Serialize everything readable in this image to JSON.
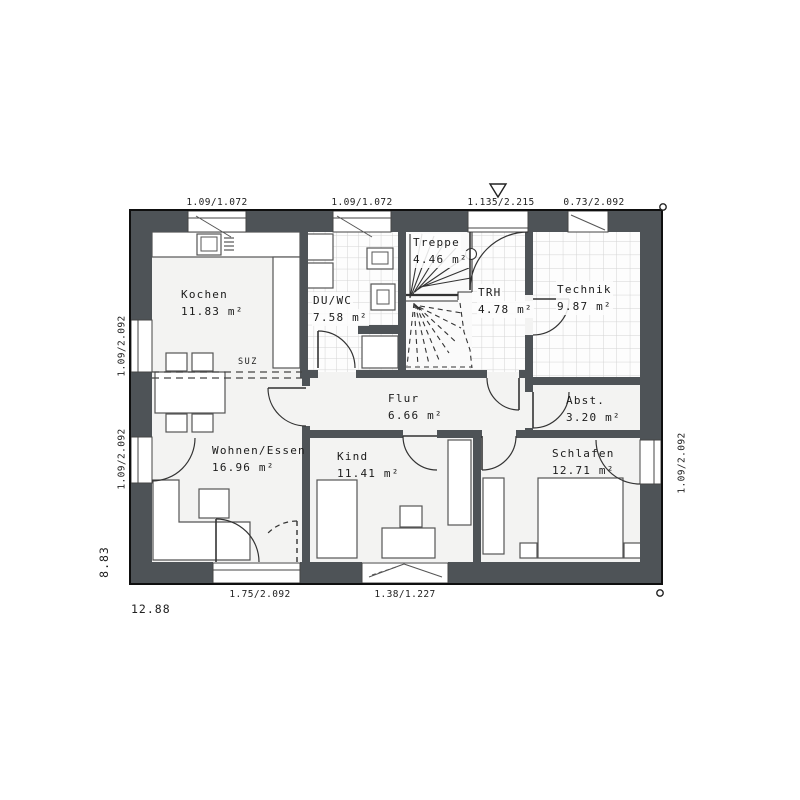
{
  "rooms": {
    "kochen": {
      "name": "Kochen",
      "area": "11.83 m²"
    },
    "duwc": {
      "name": "DU/WC",
      "area": "7.58 m²"
    },
    "treppe": {
      "name": "Treppe",
      "area": "4.46 m²"
    },
    "trh": {
      "name": "TRH",
      "area": "4.78 m²"
    },
    "technik": {
      "name": "Technik",
      "area": "9.87 m²"
    },
    "flur": {
      "name": "Flur",
      "area": "6.66 m²"
    },
    "abst": {
      "name": "Abst.",
      "area": "3.20 m²"
    },
    "wohnen": {
      "name": "Wohnen/Essen",
      "area": "16.96 m²"
    },
    "kind": {
      "name": "Kind",
      "area": "11.41 m²"
    },
    "schlafen": {
      "name": "Schlafen",
      "area": "12.71 m²"
    }
  },
  "dimensions": {
    "top": {
      "kochen_window": "1.09/1.072",
      "duwc_window": "1.09/1.072",
      "entrance_door": "1.135/2.215",
      "technik_window": "0.73/2.092"
    },
    "left": {
      "upper_window": "1.09/2.092",
      "lower_door": "1.09/2.092"
    },
    "right": {
      "balcony_door": "1.09/2.092"
    },
    "bottom": {
      "terrace_door": "1.75/2.092",
      "kind_window": "1.38/1.227"
    },
    "total_width": "12.88",
    "total_height": "8.83"
  },
  "annotations": {
    "suz": "SUZ"
  },
  "colors": {
    "wall": "#4e5357",
    "outline": "#0f0f0f",
    "floor": "#f3f3f2",
    "tile_floor": "#fdfdfd",
    "tile_line": "#d4d4d4",
    "line": "#333333"
  }
}
